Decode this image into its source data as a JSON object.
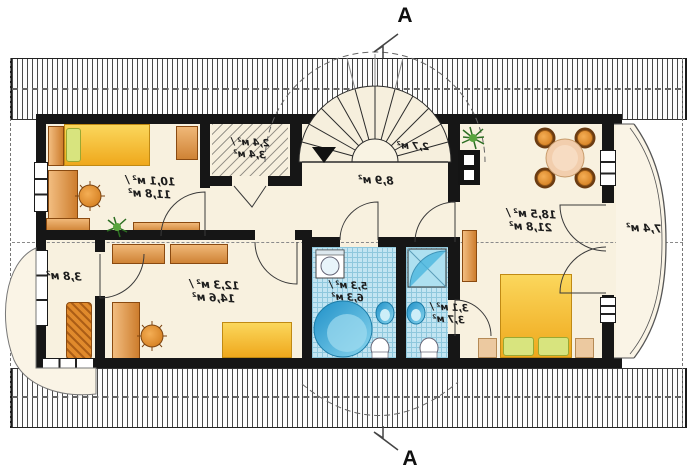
{
  "plan": {
    "type": "attic floor plan",
    "unit": "м²"
  },
  "section": {
    "top_label": "A",
    "bottom_label": "A"
  },
  "rooms": [
    {
      "name": "bedroom-top-left",
      "line1": "10,1 м² /",
      "line2": "11,8 м²"
    },
    {
      "name": "wardrobe-closet",
      "line1": "2,4 м² /",
      "line2": "3,4 м²"
    },
    {
      "name": "staircase",
      "line1": "2,7 м²",
      "line2": ""
    },
    {
      "name": "hall",
      "line1": "8,9 м²",
      "line2": ""
    },
    {
      "name": "living-room",
      "line1": "18,5 м² /",
      "line2": "21,8 м²"
    },
    {
      "name": "balcony-right",
      "line1": "7,4 м²",
      "line2": ""
    },
    {
      "name": "storage-left",
      "line1": "3,8 м²",
      "line2": ""
    },
    {
      "name": "study-bedroom",
      "line1": "12,3 м² /",
      "line2": "14,6 м²"
    },
    {
      "name": "bathroom-large",
      "line1": "5,3 м² /",
      "line2": "6,3 м²"
    },
    {
      "name": "bathroom-small",
      "line1": "3,1 м² /",
      "line2": "3,7 м²"
    }
  ],
  "colors": {
    "wall": "#161616",
    "floor": "#f8f1df",
    "tile": "#c3e5f2",
    "tileg": "#8fc8dd",
    "label": "#1c1c1c",
    "furniture_orange": "#e2912f",
    "bed_yellow": "#f6c93f",
    "pillow_green": "#d8e47e",
    "fixture_blue": "#2ea7d8",
    "plant_green": "#3d8a33",
    "table_wood": "#f2cead"
  }
}
